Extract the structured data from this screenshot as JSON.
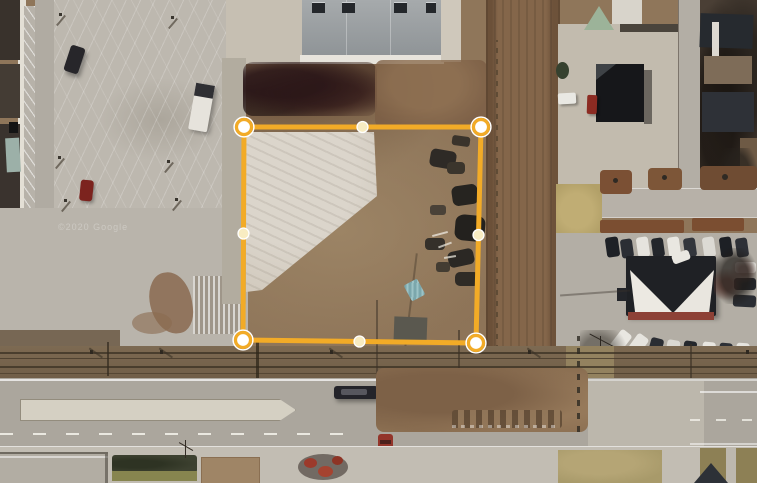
{
  "watermark": {
    "text": "©2020 Google"
  },
  "overlay": {
    "stroke_color": "#F2AB27",
    "stroke_width": 5,
    "fill": "none",
    "vertices": [
      [
        244,
        127
      ],
      [
        481,
        127
      ],
      [
        476,
        343
      ],
      [
        243,
        340
      ]
    ],
    "midpoints": [
      [
        362.5,
        127
      ],
      [
        478.5,
        235
      ],
      [
        359.5,
        341.5
      ],
      [
        243.5,
        233.5
      ]
    ],
    "vertex_handle": {
      "radius": 7.5,
      "fill": "#FFFFFF",
      "ring_color": "#F2AB27",
      "ring_width": 3.2,
      "halo_color": "#FFFFFF",
      "halo_width": 1.5
    },
    "midpoint_handle": {
      "radius": 5.5,
      "fill": "#F8ECC2",
      "ring_color": "#FFFFFF",
      "ring_width": 1.3
    }
  }
}
